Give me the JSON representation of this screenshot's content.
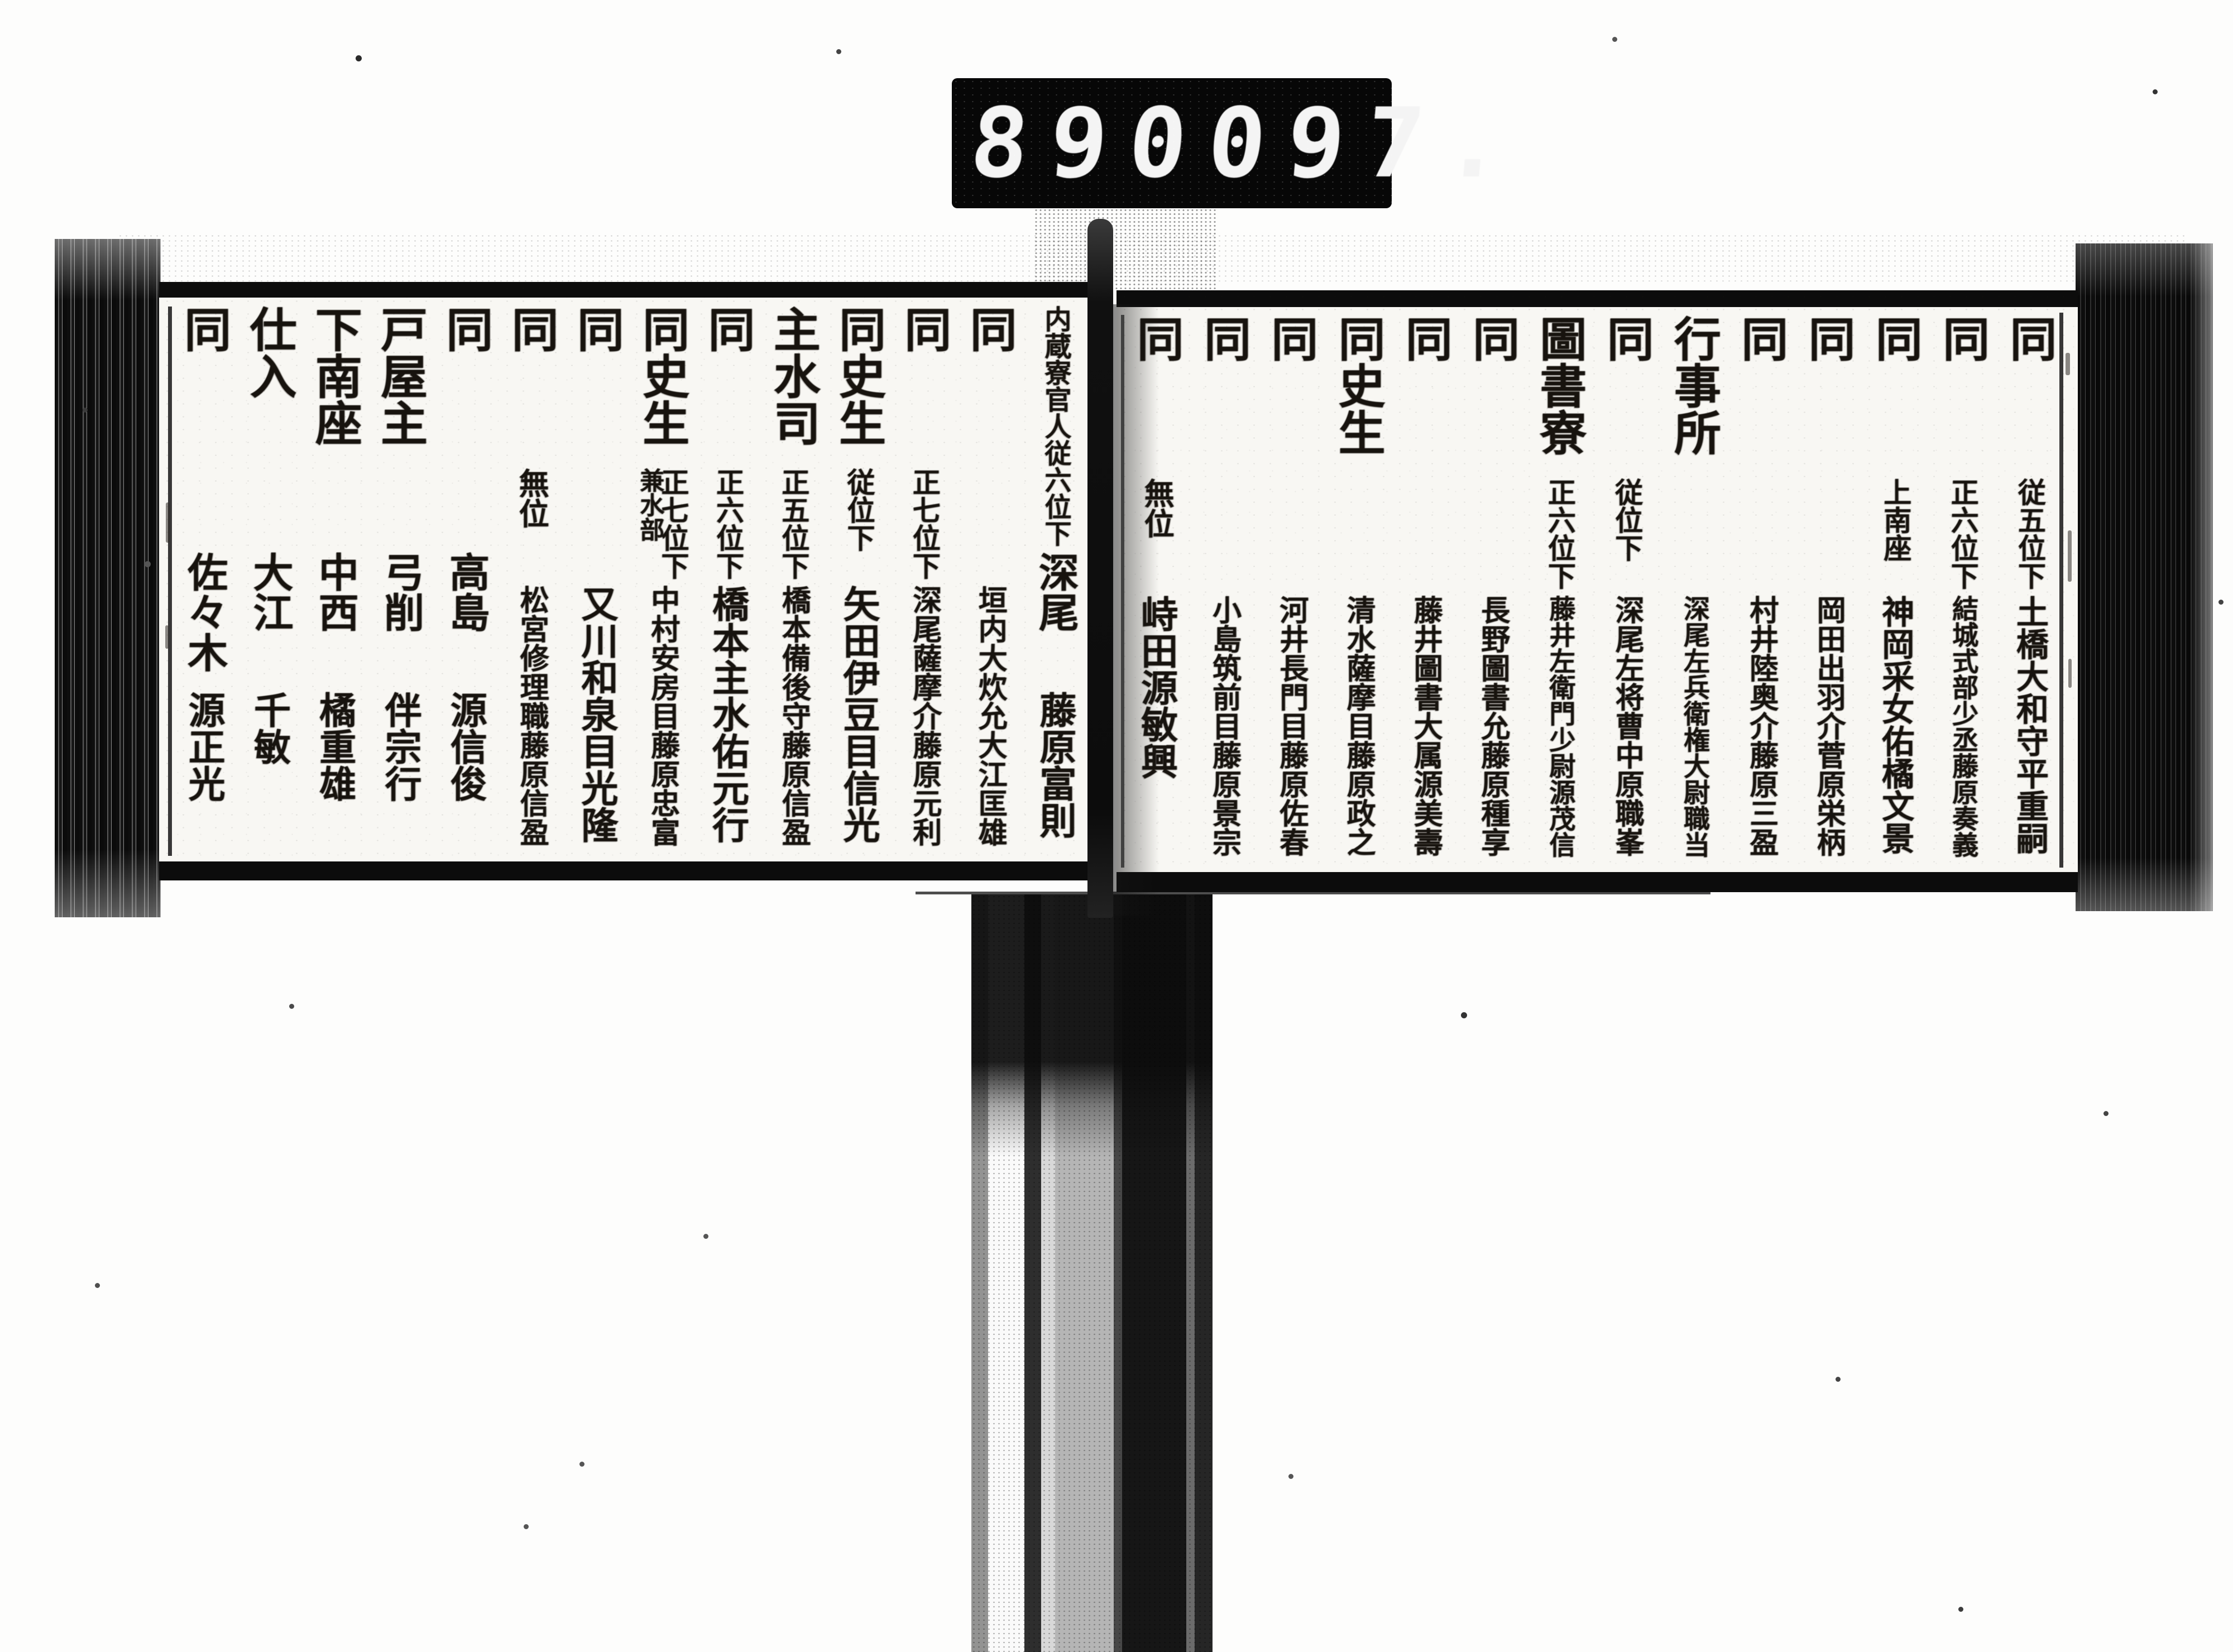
{
  "meta": {
    "description": "Scanned microfilm frame of a Japanese court personnel register, two-page spread with vertical kanji columns",
    "language": "ja",
    "reading_order": "columns right-to-left, text top-to-bottom"
  },
  "counter": {
    "left_digits": "890",
    "right_digits": "097."
  },
  "book": {
    "right_page": {
      "columns": [
        {
          "office": "同",
          "rank": "従五位下",
          "name": "土橋大和守平重嗣"
        },
        {
          "office": "同",
          "rank": "正六位下",
          "name": "結城式部少丞藤原奏義"
        },
        {
          "office": "同",
          "rank": "上南座",
          "name": "神岡采女佑橘文景"
        },
        {
          "office": "同",
          "name": "岡田出羽介菅原栄柄"
        },
        {
          "office": "同",
          "name": "村井陸奥介藤原三盈"
        },
        {
          "office": "行事所",
          "name": "深尾左兵衛権大尉職当"
        },
        {
          "office": "同",
          "rank": "従位下",
          "name": "深尾左将曹中原職峯"
        },
        {
          "office": "圖書寮",
          "rank": "正六位下",
          "name": "藤井左衛門少尉源茂信"
        },
        {
          "office": "同",
          "name": "長野圖書允藤原種享"
        },
        {
          "office": "同",
          "name": "藤井圖書大属源美壽"
        },
        {
          "office": "同史生",
          "name": "清水薩摩目藤原政之"
        },
        {
          "office": "同",
          "name": "河井長門目藤原佐春"
        },
        {
          "office": "同",
          "name": "小島筑前目藤原景宗"
        },
        {
          "office": "同",
          "rank": "無位",
          "name": "峙田源敏興"
        }
      ]
    },
    "left_page": {
      "columns": [
        {
          "office": "内蔵寮官人従六位下",
          "surname": "深尾",
          "given": "藤原富則"
        },
        {
          "office": "同",
          "name": "垣内大炊允大江匡雄"
        },
        {
          "office": "同",
          "rank": "正七位下",
          "name": "深尾薩摩介藤原元利"
        },
        {
          "office": "同史生",
          "rank": "従位下",
          "name": "矢田伊豆目信光"
        },
        {
          "office": "主水司",
          "rank": "正五位下",
          "name": "橋本備後守藤原信盈"
        },
        {
          "office": "同",
          "rank": "正六位下",
          "name": "橋本主水佑元行"
        },
        {
          "office": "同史生",
          "rank": "正七位下",
          "rank2": "兼水部",
          "name": "中村安房目藤原忠富"
        },
        {
          "office": "同",
          "name": "又川和泉目光隆"
        },
        {
          "office": "同",
          "rank": "無位",
          "name": "松宮修理職藤原信盈"
        },
        {
          "office": "同",
          "surname": "高島",
          "given": "源信俊"
        },
        {
          "office": "戸屋主",
          "surname": "弓削",
          "given": "伴宗行"
        },
        {
          "office": "下南座",
          "surname": "中西",
          "given": "橘重雄"
        },
        {
          "office": "仕入",
          "surname": "大江",
          "given": "千敏"
        },
        {
          "office": "同",
          "surname": "佐々木",
          "given": "源正光"
        }
      ]
    }
  },
  "colors": {
    "paper": "#f8f7f3",
    "ink": "#17130e",
    "counter_bg": "#070707",
    "counter_digits": "#f4f4f4",
    "edge_dark": "#0c0c0c"
  }
}
